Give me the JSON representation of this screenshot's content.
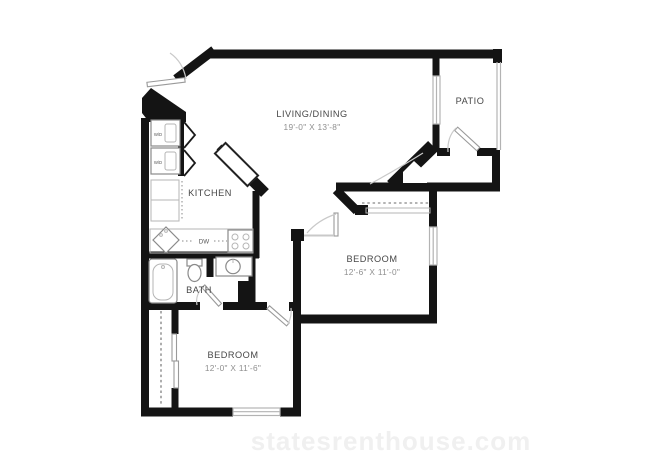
{
  "rooms": {
    "living_dining": {
      "name": "LIVING/DINING",
      "dims": "19'-0\" X 13'-8\""
    },
    "patio": {
      "name": "PATIO"
    },
    "kitchen": {
      "name": "KITCHEN"
    },
    "bath": {
      "name": "BATH"
    },
    "bedroom_right": {
      "name": "BEDROOM",
      "dims": "12'-6\" X 11'-0\""
    },
    "bedroom_bottom": {
      "name": "BEDROOM",
      "dims": "12'-0\" X 11'-6\""
    }
  },
  "labels": {
    "washer_dryer": "W/D",
    "dishwasher": "DW"
  },
  "watermark": "statesrenthouse.com",
  "colors": {
    "wall": "#141414",
    "fixture_line": "#8a8a8a",
    "room_label": "#474747",
    "dimension_label": "#8f8f8f",
    "watermark": "#f0f0f0",
    "background": "#ffffff"
  }
}
